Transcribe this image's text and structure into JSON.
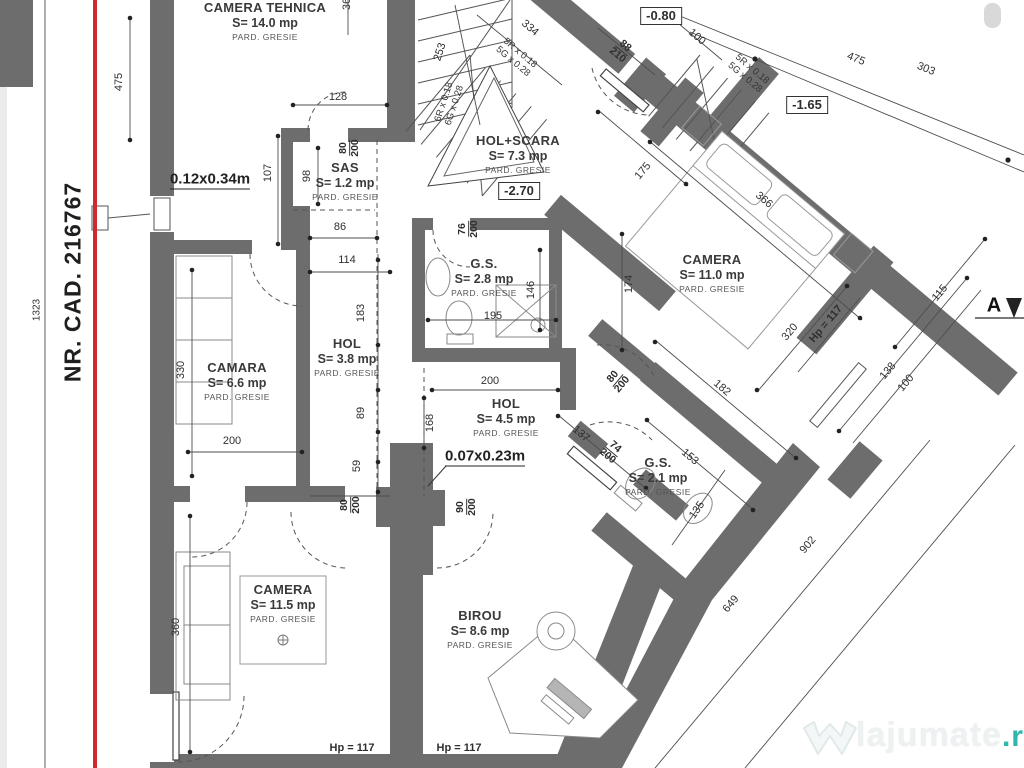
{
  "cadastral": {
    "number": "NR. CAD. 216767"
  },
  "rooms": [
    {
      "name": "CAMERA TEHNICA",
      "area": "S= 14.0 mp",
      "floor": "PARD. GRESIE"
    },
    {
      "name": "SAS",
      "area": "S= 1.2 mp",
      "floor": "PARD. GRESIE"
    },
    {
      "name": "HOL+SCARA",
      "area": "S= 7.3 mp",
      "floor": "PARD. GRESIE"
    },
    {
      "name": "G.S.",
      "area": "S= 2.8 mp",
      "floor": "PARD. GRESIE"
    },
    {
      "name": "CAMERA",
      "area": "S= 11.0 mp",
      "floor": "PARD. GRESIE"
    },
    {
      "name": "CAMARA",
      "area": "S= 6.6 mp",
      "floor": "PARD. GRESIE"
    },
    {
      "name": "HOL",
      "area": "S= 3.8 mp",
      "floor": "PARD. GRESIE"
    },
    {
      "name": "HOL",
      "area": "S= 4.5 mp",
      "floor": "PARD. GRESIE"
    },
    {
      "name": "G.S.",
      "area": "S= 2.1 mp",
      "floor": "PARD. GRESIE"
    },
    {
      "name": "CAMERA",
      "area": "S= 11.5 mp",
      "floor": "PARD. GRESIE"
    },
    {
      "name": "BIROU",
      "area": "S= 8.6 mp",
      "floor": "PARD. GRESIE"
    }
  ],
  "levels": {
    "hall": "-2.70",
    "landing": "-0.80",
    "upper": "-1.65"
  },
  "notes": {
    "window_small": "0.12x0.34m",
    "window_tiny": "0.07x0.23m"
  },
  "stairs": {
    "left_r": "6R x 0.18",
    "left_g": "6G x 0.28",
    "mid_r": "5R x 0.18",
    "mid_g": "5G x 0.28",
    "top_r": "5R x 0.18",
    "top_g": "5G x 0.28"
  },
  "section": {
    "marker": "A"
  },
  "hp": {
    "right": "Hp = 117",
    "camera": "Hp = 117",
    "birou": "Hp = 117"
  },
  "dims": {
    "d1323": "1323",
    "d475": "475",
    "d107": "107",
    "d98": "98",
    "d128": "128",
    "d36": "36",
    "d80a": "80",
    "d200a": "200",
    "d86": "86",
    "d114": "114",
    "d76": "76",
    "d200b": "200",
    "d183": "183",
    "d330": "330",
    "d200c": "200",
    "d89": "89",
    "d59": "59",
    "d80b": "80",
    "d200d": "200",
    "d90": "90",
    "d200e": "200",
    "d168": "168",
    "d200f": "200",
    "d195": "195",
    "d146": "146",
    "d253": "253",
    "d334": "334",
    "d88": "88",
    "d210": "210",
    "d100top": "100",
    "d475diag": "475",
    "d303": "303",
    "d175": "175",
    "d366": "366",
    "d174": "174",
    "d320": "320",
    "d182": "182",
    "d115": "115",
    "d138": "138",
    "d100right": "100",
    "d137": "137",
    "d74": "74",
    "d200g": "200",
    "d153": "153",
    "d135": "135",
    "d902": "902",
    "d649": "649",
    "d360": "360",
    "d80c": "80",
    "d200h": "200"
  },
  "watermark": {
    "name": "lajumate",
    "tld": ".ro"
  }
}
